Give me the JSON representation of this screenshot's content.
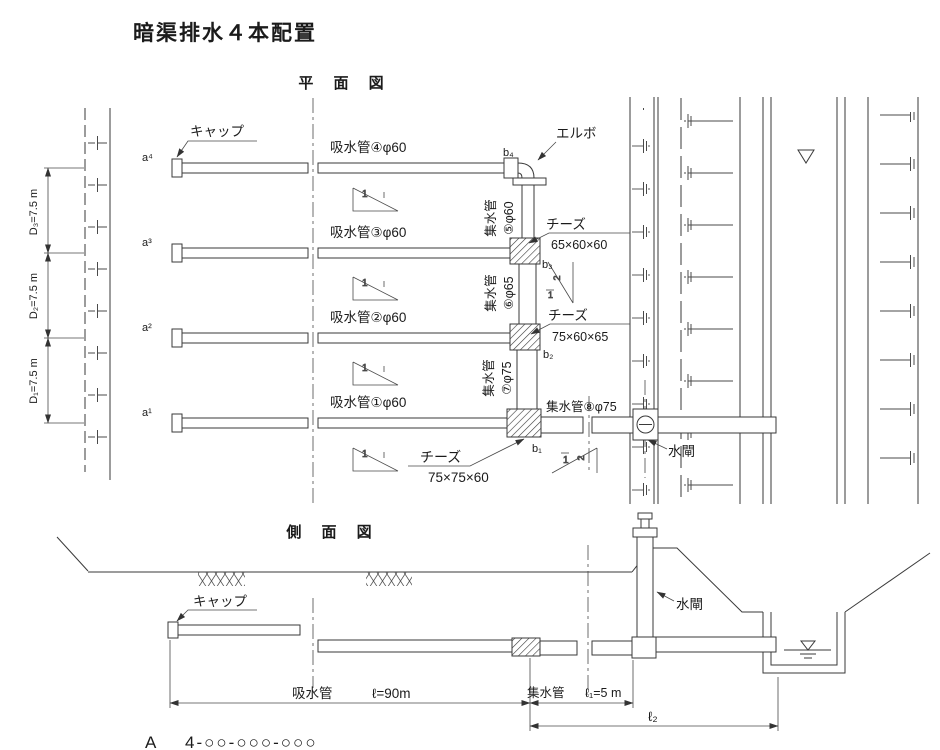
{
  "title": "暗渠排水４本配置",
  "plan": {
    "title": "平 面 図",
    "cap_label": "キャップ",
    "elbow_label": "エルボ",
    "sluice_label": "水閘",
    "suction4": "吸水管④φ60",
    "suction3": "吸水管③φ60",
    "suction2": "吸水管②φ60",
    "suction1": "吸水管①φ60",
    "collector_name": "集水管",
    "collector5_size": "⑤φ60",
    "collector6_size": "⑥φ65",
    "collector7_size": "⑦φ75",
    "collector8": "集水管⑧φ75",
    "tee_label": "チーズ",
    "tee1_size": "65×60×60",
    "tee2_size": "75×60×65",
    "tee3_size": "75×75×60",
    "a4": "a⁴",
    "a3": "a³",
    "a2": "a²",
    "a1": "a¹",
    "b4": "b₄",
    "b3": "b₃",
    "b2": "b₂",
    "b1": "b₁",
    "d3": "D₃=7.5 m",
    "d2": "D₂=7.5 m",
    "d1": "D₁=7.5 m",
    "slope_one": "1",
    "slope_two": "2"
  },
  "side": {
    "title": "側 面 図",
    "cap_label": "キャップ",
    "sluice_label": "水閘",
    "suction_label": "吸水管",
    "suction_length": "ℓ=90m",
    "collector_label": "集水管",
    "collector_length": "ℓ₁=5 m",
    "l2_label": "ℓ₂"
  },
  "drawing_number": {
    "prefix": "A",
    "value": "4-○○-○○○-○○○"
  }
}
